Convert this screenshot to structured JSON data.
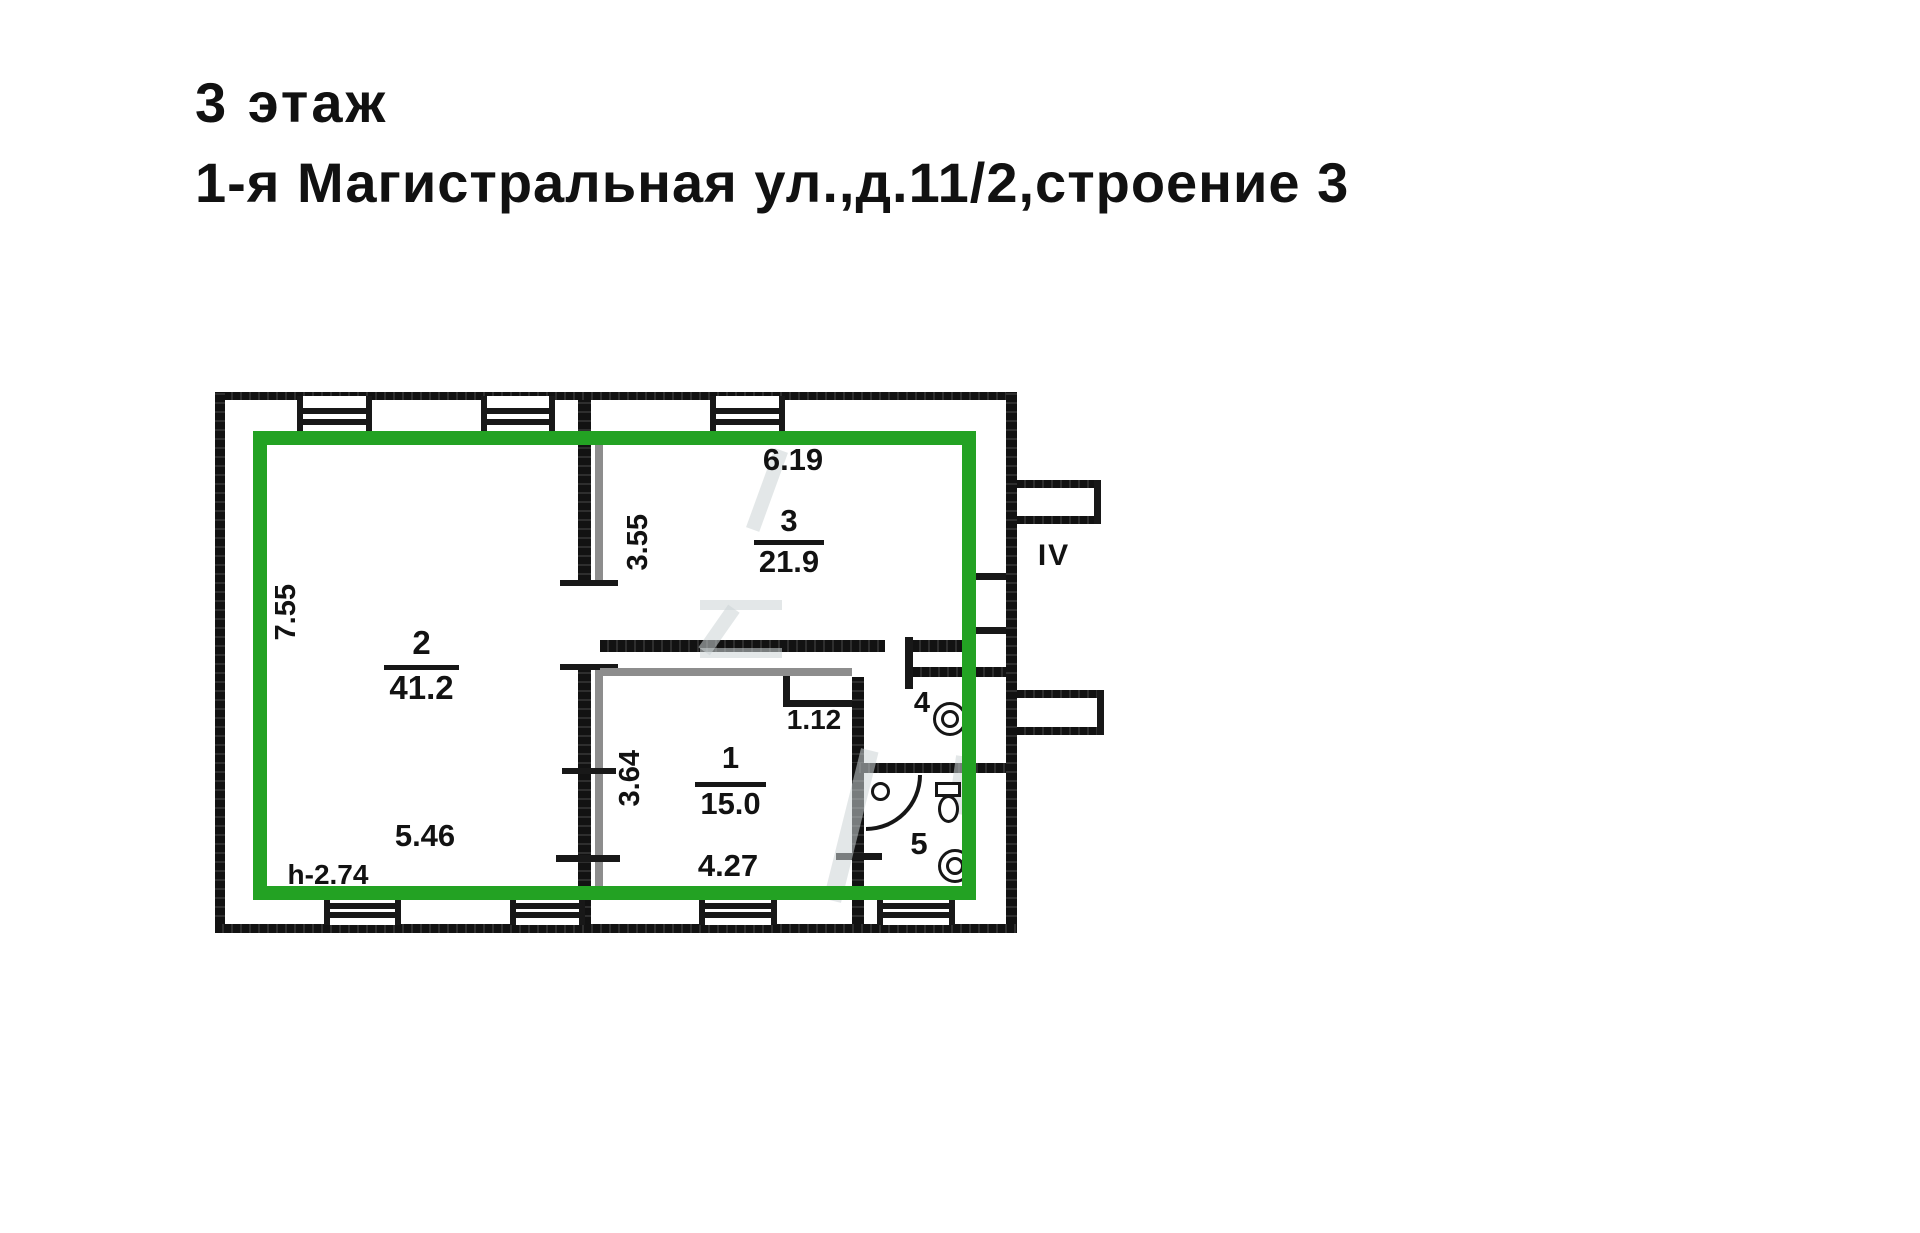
{
  "page": {
    "title_line1": "3 этаж",
    "title_line2": "1-я Магистральная ул.,д.11/2,строение 3"
  },
  "plan": {
    "highlight_color": "#23a223",
    "stair_label": "IV",
    "ceiling_height_note": "h-2.74",
    "rooms": [
      {
        "number": "2",
        "area": "41.2"
      },
      {
        "number": "3",
        "area": "21.9"
      },
      {
        "number": "1",
        "area": "15.0"
      },
      {
        "number": "4",
        "area": ""
      },
      {
        "number": "5",
        "area": ""
      }
    ],
    "dimensions": {
      "room2_depth": "7.55",
      "room2_width": "5.46",
      "room3_width": "6.19",
      "room3_depth": "3.55",
      "room1_width": "4.27",
      "room1_depth": "3.64",
      "niche_width": "1.12"
    }
  }
}
